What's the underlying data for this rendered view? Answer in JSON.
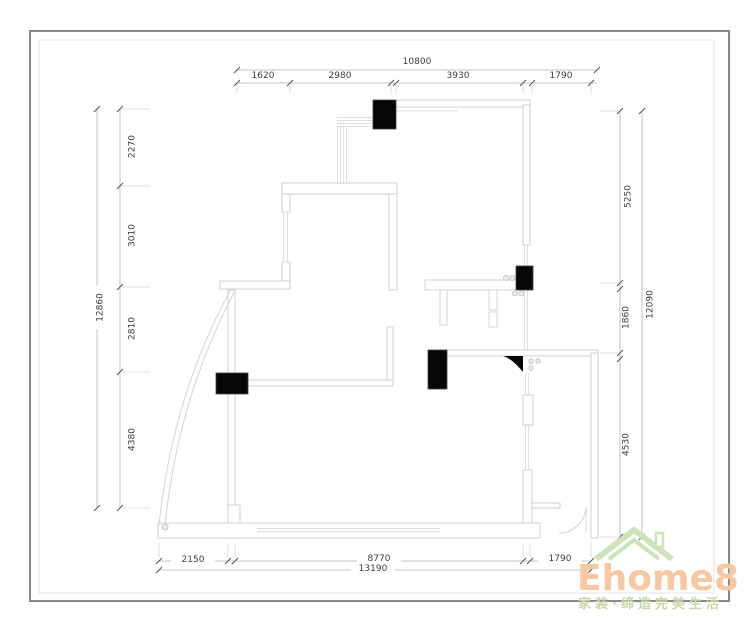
{
  "dimensions": {
    "top": {
      "total": "10800",
      "segments": [
        "1620",
        "2980",
        "3930",
        "1790"
      ]
    },
    "left": {
      "total": "12860",
      "segments": [
        "2270",
        "3010",
        "2810",
        "4380"
      ]
    },
    "right": {
      "total": "12090",
      "segments": [
        "5250",
        "1860",
        "4530"
      ]
    },
    "bottom": {
      "total": "13190",
      "segments": [
        "2150",
        "8770",
        "1790"
      ]
    }
  },
  "logo": {
    "brand": "Ehome8",
    "slogan": "家装·缔造完美生活",
    "brand_color": "#f7c8a2",
    "roof_color": "#cfe3ba",
    "slogan_color": "#c6d7a8"
  },
  "drawing": {
    "wall_color": "#cfcfcf",
    "dim_line_color": "#adadad",
    "tick_color": "#555555",
    "solid_fill_color": "#060606"
  }
}
